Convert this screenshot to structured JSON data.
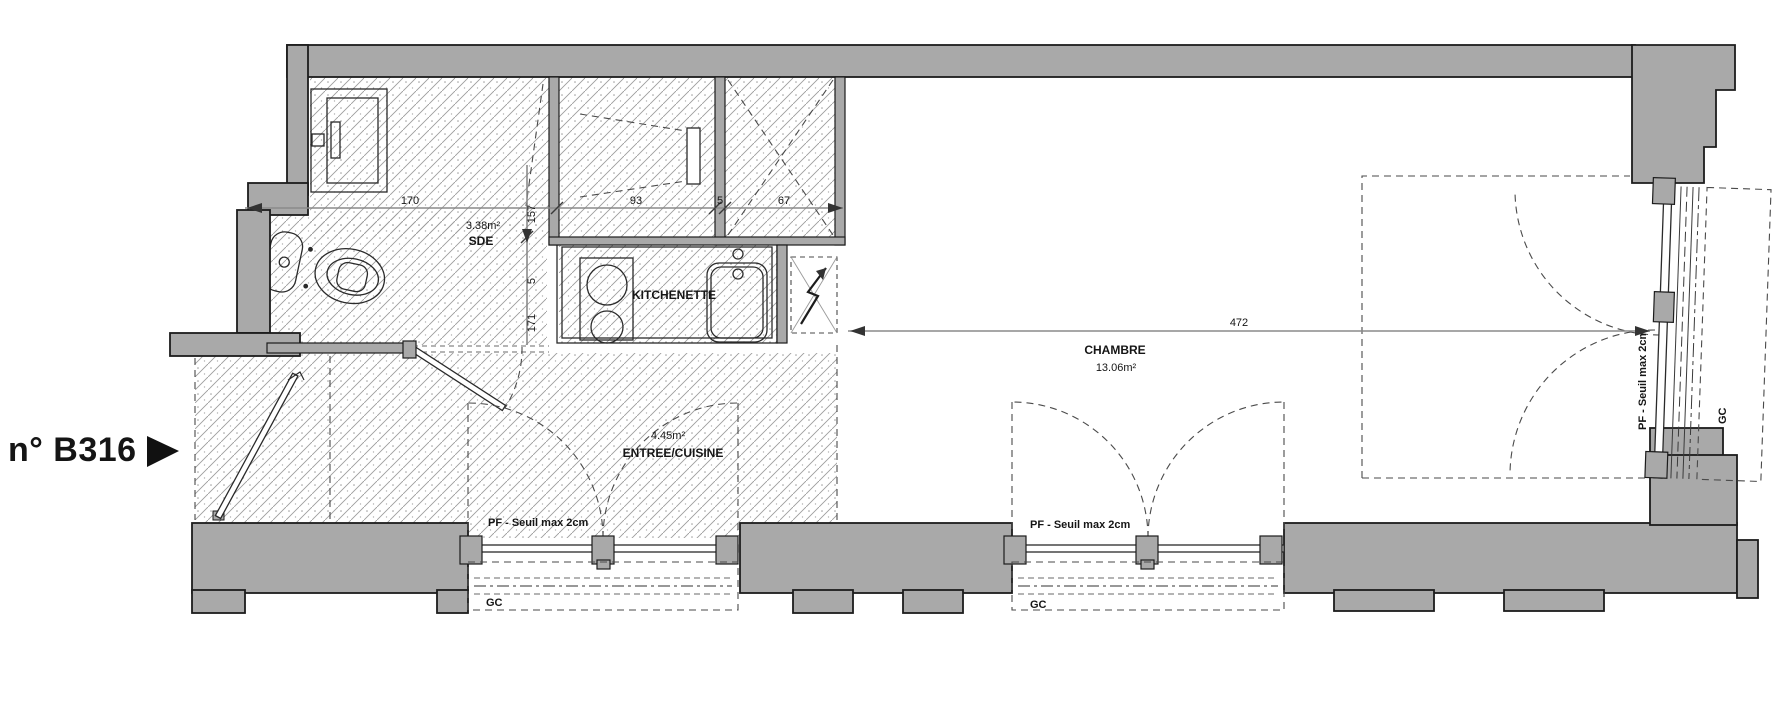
{
  "unit": {
    "label": "n° B316"
  },
  "rooms": {
    "sde": {
      "name": "SDE",
      "area": "3.38m²"
    },
    "kitchenette": {
      "name": "KITCHENETTE"
    },
    "entree": {
      "name": "ENTREE/CUISINE",
      "area": "4.45m²"
    },
    "chambre": {
      "name": "CHAMBRE",
      "area": "13.06m²"
    }
  },
  "dimensions": {
    "sde_width": "170",
    "sde_depth": "157",
    "closet_width": "93",
    "partition_a": "5",
    "entry_closet_width": "67",
    "chambre_width": "472",
    "partition_b": "5",
    "entree_depth": "171"
  },
  "windows": {
    "window1": {
      "type_label": "PF - Seuil max 2cm",
      "guard_label": "GC"
    },
    "window2": {
      "type_label": "PF - Seuil max 2cm",
      "guard_label": "GC"
    },
    "window_right": {
      "type_label": "PF - Seuil max 2cm",
      "guard_label": "GC"
    }
  },
  "icons": {
    "entrance_arrow": "right-triangle",
    "electrical_panel": "lightning-arrow"
  },
  "colors": {
    "wall_fill": "#a9a9a9",
    "outline": "#1c1c1c",
    "hatch": "#9c9c9c",
    "dimension_line": "#8a8a8a"
  }
}
